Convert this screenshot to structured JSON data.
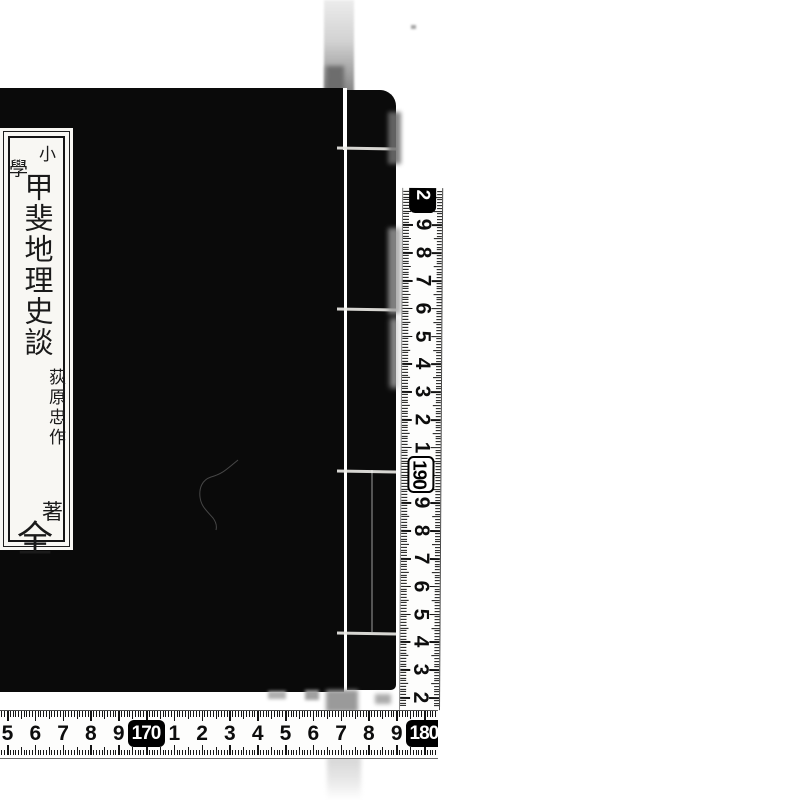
{
  "book": {
    "cover_color": "#0a0a0a",
    "title_slip": {
      "series_chars": [
        "小",
        "學"
      ],
      "title": "甲斐地理史談",
      "author": "荻原忠作",
      "author_suffix": "著",
      "volume": "全"
    }
  },
  "rulers": {
    "bottom": {
      "orientation": "horizontal",
      "marks": [
        {
          "label": "5"
        },
        {
          "label": "6"
        },
        {
          "label": "7"
        },
        {
          "label": "8"
        },
        {
          "label": "9"
        },
        {
          "label": "170",
          "box": "solid"
        },
        {
          "label": "1"
        },
        {
          "label": "2"
        },
        {
          "label": "3"
        },
        {
          "label": "4"
        },
        {
          "label": "5"
        },
        {
          "label": "6"
        },
        {
          "label": "7"
        },
        {
          "label": "8"
        },
        {
          "label": "9"
        },
        {
          "label": "180",
          "box": "solid",
          "clipped": true
        }
      ]
    },
    "right": {
      "orientation": "vertical",
      "marks_bottom_to_top": [
        {
          "label": "2"
        },
        {
          "label": "3"
        },
        {
          "label": "4"
        },
        {
          "label": "5"
        },
        {
          "label": "6"
        },
        {
          "label": "7"
        },
        {
          "label": "8"
        },
        {
          "label": "9"
        },
        {
          "label": "190",
          "box": "outline"
        },
        {
          "label": "1"
        },
        {
          "label": "2"
        },
        {
          "label": "3"
        },
        {
          "label": "4"
        },
        {
          "label": "5"
        },
        {
          "label": "6"
        },
        {
          "label": "7"
        },
        {
          "label": "8"
        },
        {
          "label": "9"
        },
        {
          "label": "2",
          "box": "solid",
          "clipped": true
        }
      ]
    }
  },
  "colors": {
    "background": "#ffffff",
    "book": "#0a0a0a",
    "slip_paper": "#f8f7f3",
    "tape_paper": "#fdfdfc",
    "marks": "#141414",
    "smudge": "#9c9c9c"
  }
}
